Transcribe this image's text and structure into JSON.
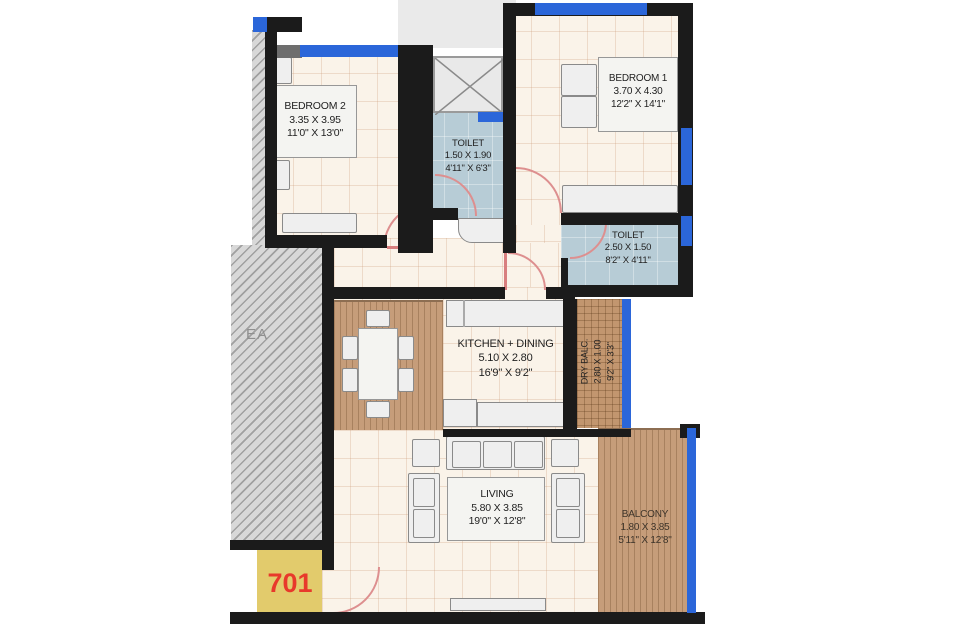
{
  "unit": {
    "number": "701"
  },
  "common_area": {
    "partial_label": "EA"
  },
  "rooms": {
    "bedroom2": {
      "name": "BEDROOM 2",
      "dim_m": "3.35 X 3.95",
      "dim_ft": "11'0\" X 13'0\""
    },
    "bedroom1": {
      "name": "BEDROOM 1",
      "dim_m": "3.70 X 4.30",
      "dim_ft": "12'2\" X 14'1\""
    },
    "toilet1": {
      "name": "TOILET",
      "dim_m": "1.50 X 1.90",
      "dim_ft": "4'11\" X 6'3\""
    },
    "toilet2": {
      "name": "TOILET",
      "dim_m": "2.50 X 1.50",
      "dim_ft": "8'2\" X 4'11\""
    },
    "kitchen_dining": {
      "name": "KITCHEN + DINING",
      "dim_m": "5.10 X 2.80",
      "dim_ft": "16'9\" X 9'2\""
    },
    "dry_balcony": {
      "name": "DRY BALC.",
      "dim_m": "2.80 X 1.00",
      "dim_ft": "9'2\" X 3'3\""
    },
    "living": {
      "name": "LIVING",
      "dim_m": "5.80 X 3.85",
      "dim_ft": "19'0\" X 12'8\""
    },
    "balcony": {
      "name": "BALCONY",
      "dim_m": "1.80 X 3.85",
      "dim_ft": "5'11\" X 12'8\""
    }
  },
  "colors": {
    "wall_black": "#1b1b1b",
    "window_blue": "#2b66d9",
    "toilet_floor_blue": "#b7ccd6",
    "floor_cream": "#faf3e9",
    "deck_wood_brown": "#c69d7a",
    "hatch_gray": "#d8d8d8",
    "unit_box_yellow": "#e2cb6c",
    "unit_number_red": "#e8392b",
    "door_arc_red": "#dd8f8f"
  }
}
